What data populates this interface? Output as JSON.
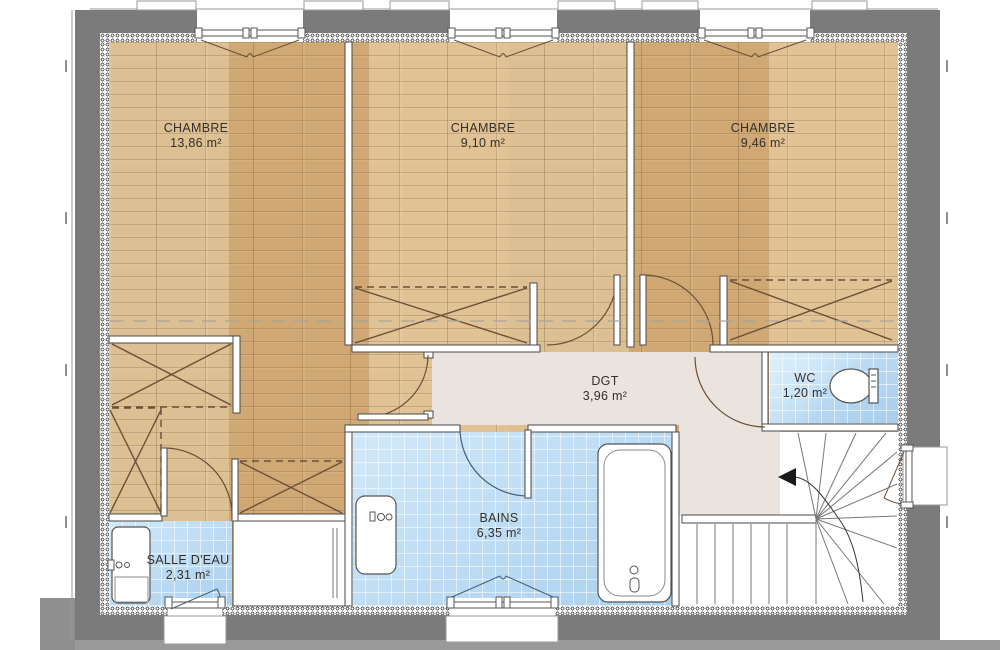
{
  "plan": {
    "title": "Plan d'étage",
    "rooms": [
      {
        "key": "chambre1",
        "name": "CHAMBRE",
        "area": "13,86 m²",
        "floor": "wood"
      },
      {
        "key": "chambre2",
        "name": "CHAMBRE",
        "area": "9,10 m²",
        "floor": "wood"
      },
      {
        "key": "chambre3",
        "name": "CHAMBRE",
        "area": "9,46 m²",
        "floor": "wood"
      },
      {
        "key": "dgt",
        "name": "DGT",
        "area": "3,96 m²",
        "floor": "hallway"
      },
      {
        "key": "wc",
        "name": "WC",
        "area": "1,20 m²",
        "floor": "tile"
      },
      {
        "key": "bains",
        "name": "BAINS",
        "area": "6,35 m²",
        "floor": "tile"
      },
      {
        "key": "salle_deau",
        "name": "SALLE D'EAU",
        "area": "2,31 m²",
        "floor": "tile"
      }
    ],
    "features": {
      "stair_direction_icon": "left-arrow",
      "fixtures": [
        "toilet",
        "bathtub",
        "washbasin-bains",
        "washbasin-salle-deau"
      ],
      "closets": 5,
      "windows_top": 3,
      "windows_bottom": 2,
      "windows_right": 1
    },
    "colors": {
      "wall": "#7b7b7b",
      "wood": "#d7b283",
      "tile": "#b9dcf6",
      "hallway": "#eae3de",
      "line": "#6b4f38",
      "outline": "#4a4a4a"
    }
  }
}
